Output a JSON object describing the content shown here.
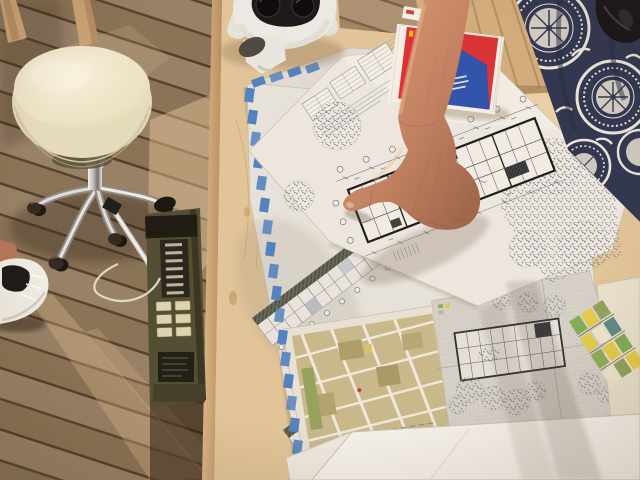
{
  "image": {
    "kind": "photograph",
    "caption": "Hand pointing at an architectural floor plan among overlapping drawing sheets on a plywood table, outdoors on a wooden deck"
  },
  "palette": {
    "deck_brown": "#8c7760",
    "deck_gap": "#53422f",
    "table_wood": "#e0c69c",
    "table_edge": "#c4a075",
    "paper": "#e7e5e0",
    "paper_bright": "#f6f5f1",
    "drawing_line": "#6b717b",
    "plan_dark": "#1d2025",
    "tape_blue": "#4d82c4",
    "book_red": "#d93038",
    "book_yellow": "#f2c41f",
    "book_blue": "#2a52b0",
    "stool_cream": "#f2eeda",
    "chrome": "#cccccc",
    "radio_olive": "#4e4c33",
    "radio_key_cream": "#ddd5b5",
    "skin": "#c68a69",
    "dress_navy": "#2b3552",
    "dress_white": "#e9e6df",
    "headset_white": "#ecedeb",
    "lens_dark": "#07080b",
    "map_olive": "#c6ba8e",
    "map_green": "#8fa35f",
    "shoe_white": "#f0efe9"
  },
  "book": {
    "cover_glyph": "S"
  },
  "objects": [
    {
      "name": "wood-deck",
      "label": "diagonal wooden deck boards"
    },
    {
      "name": "chair-legs",
      "label": "wooden chair legs"
    },
    {
      "name": "rolling-stool",
      "label": "cream round stool with chrome casters"
    },
    {
      "name": "white-sneaker",
      "label": "white sneaker"
    },
    {
      "name": "field-radio",
      "label": "olive-green portable radio"
    },
    {
      "name": "white-cable",
      "label": "thin white cable"
    },
    {
      "name": "plywood-table",
      "label": "birch plywood table"
    },
    {
      "name": "elevation-sheet",
      "label": "large sheet with blue tape border and building elevations"
    },
    {
      "name": "floor-plan-sheet",
      "label": "sheet with long rectangular floor plan and trees"
    },
    {
      "name": "site-plan-sheet",
      "label": "site plan with building footprint and tree clusters"
    },
    {
      "name": "city-map-sheet",
      "label": "olive-toned city map print"
    },
    {
      "name": "colored-map",
      "label": "colored map at right edge"
    },
    {
      "name": "white-sheets",
      "label": "blank white sheets"
    },
    {
      "name": "red-book",
      "label": "red book with yellow S on cover"
    },
    {
      "name": "vr-headset",
      "label": "white VR headset with dark lenses"
    },
    {
      "name": "pointing-hand",
      "label": "bare arm and hand pointing at the floor plan"
    },
    {
      "name": "patterned-dress",
      "label": "navy dress with white medallion pattern"
    },
    {
      "name": "dark-object",
      "label": "dark object at top right corner"
    }
  ]
}
